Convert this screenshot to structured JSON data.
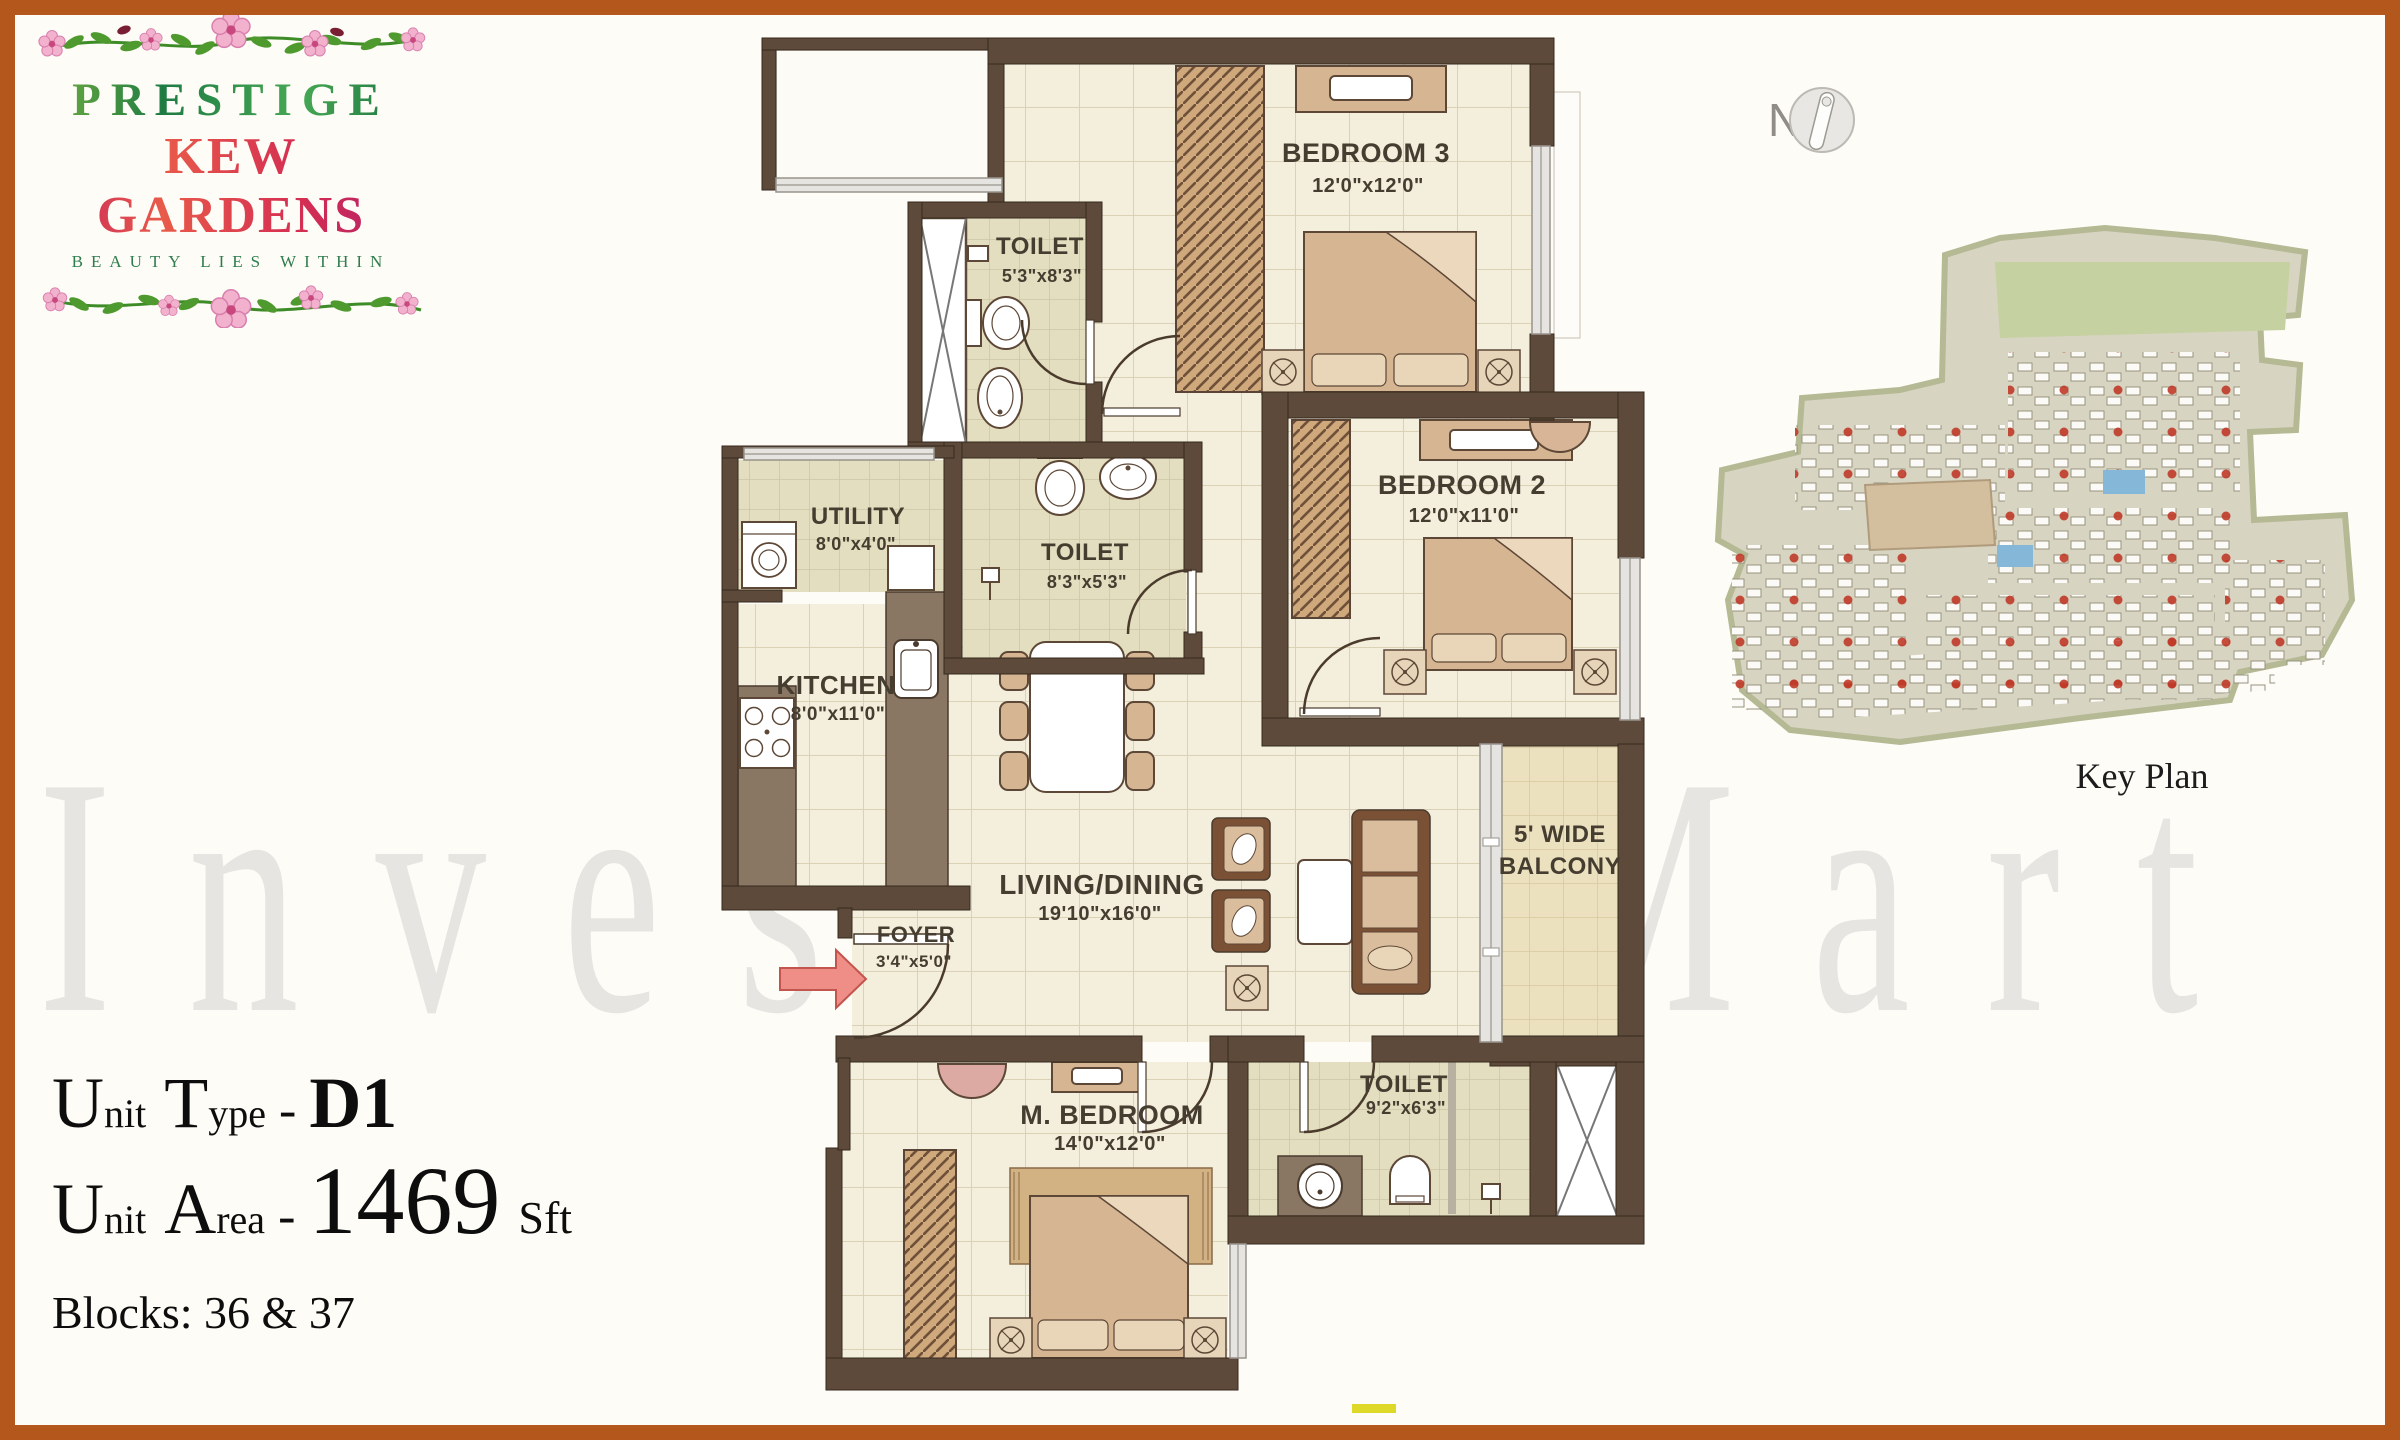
{
  "logo": {
    "name": "PRESTIGE",
    "subname": "KEW GARDENS",
    "tagline": "BEAUTY LIES WITHIN"
  },
  "watermark": "InvestorsMart",
  "compass": {
    "label": "N"
  },
  "key_plan": {
    "label": "Key Plan"
  },
  "unit_info": {
    "type": {
      "c1": "U",
      "s1": "nit",
      "c2": "T",
      "s2": "ype",
      "dash": "-",
      "value": "D1"
    },
    "area": {
      "c1": "U",
      "s1": "nit",
      "c2": "A",
      "s2": "rea",
      "dash": "-",
      "value": "1469",
      "suffix": "Sft"
    },
    "blocks": "Blocks: 36 & 37"
  },
  "rooms": {
    "bedroom3": {
      "name": "BEDROOM 3",
      "dims": "12'0\"x12'0\""
    },
    "toilet1": {
      "name": "TOILET",
      "dims": "5'3\"x8'3\""
    },
    "bedroom2": {
      "name": "BEDROOM 2",
      "dims": "12'0\"x11'0\""
    },
    "toilet2": {
      "name": "TOILET",
      "dims": "8'3\"x5'3\""
    },
    "utility": {
      "name": "UTILITY",
      "dims": "8'0\"x4'0\""
    },
    "kitchen": {
      "name": "KITCHEN",
      "dims": "8'0\"x11'0\""
    },
    "living": {
      "name": "LIVING/DINING",
      "dims": "19'10\"x16'0\""
    },
    "foyer": {
      "name": "FOYER",
      "dims": "3'4\"x5'0\""
    },
    "mbedroom": {
      "name": "M. BEDROOM",
      "dims": "14'0\"x12'0\""
    },
    "mtoilet": {
      "name": "TOILET",
      "dims": "9'2\"x6'3\""
    },
    "balcony": {
      "line1": "5' WIDE",
      "line2": "BALCONY"
    }
  },
  "colors": {
    "frame": "#b4571c",
    "wall": "#5e4a3a",
    "floor_tile": "#f4eedd",
    "bath_tile": "#e3debf",
    "balcony_tile": "#ece1bf",
    "furniture_tan": "#d6b592",
    "entry_arrow": "#ef8e87",
    "watermark_gray": "#8f8f8f",
    "logo_green": "#2e8b44",
    "logo_pink": "#c21a62",
    "keyplan_red_dot": "#c03a28",
    "yellow_mark": "#ded829"
  }
}
